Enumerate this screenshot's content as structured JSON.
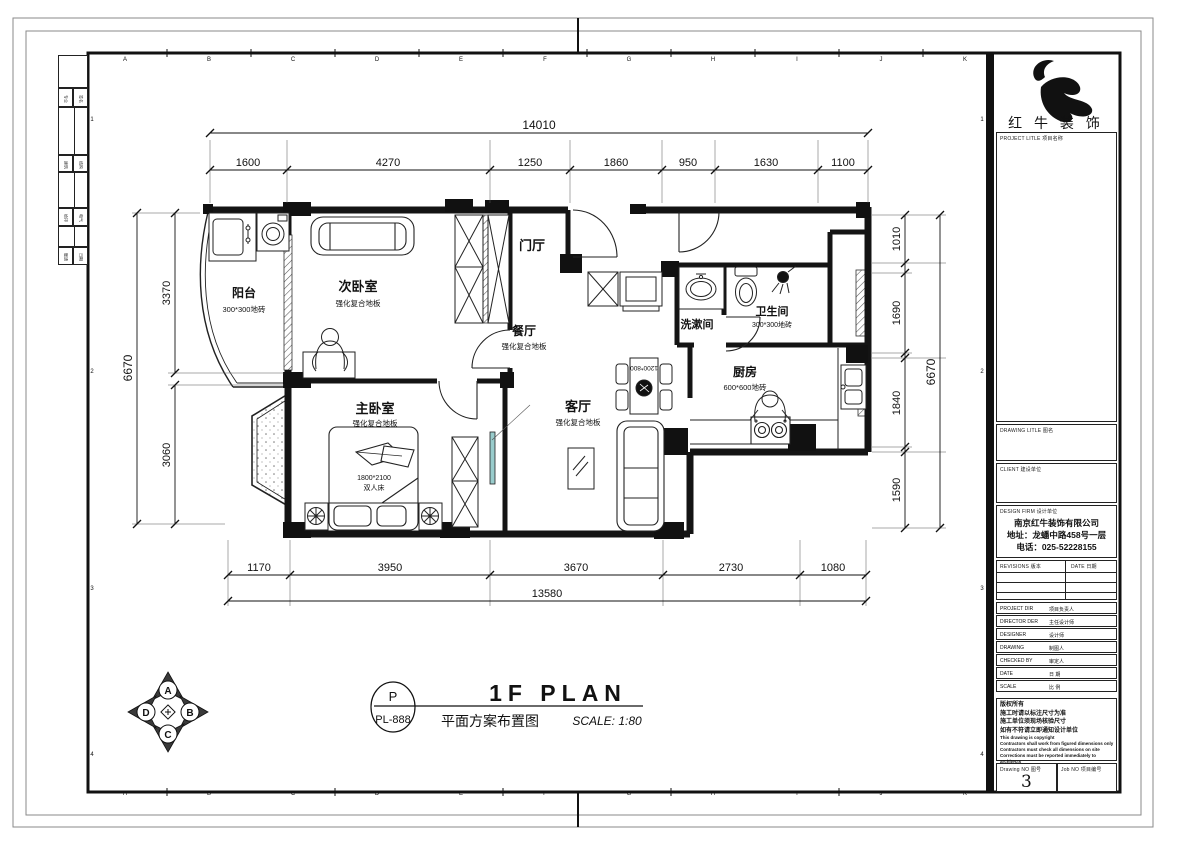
{
  "sheet": {
    "grid_top": [
      "A",
      "B",
      "C",
      "D",
      "E",
      "F",
      "G",
      "H",
      "I",
      "J",
      "K"
    ],
    "grid_side": [
      "1",
      "2",
      "3",
      "4"
    ],
    "side_strip": [
      [
        "专业",
        "签名"
      ],
      [
        "建筑",
        "结构"
      ],
      [
        "给排",
        "电气"
      ],
      [
        "暖通",
        "日期"
      ]
    ]
  },
  "title_block": {
    "logo_text": "红 牛 装 饰",
    "project_title_label": "PROJECT LITLE  项目名称",
    "drawing_title_label": "DRAWING LITLE  图名",
    "client_label": "CLIENT  建设单位",
    "design_firm_label": "DESIGN FIRM  设计单位",
    "company_name": "南京红牛装饰有限公司",
    "company_address": "地址：龙蟠中路458号一层",
    "company_phone": "电话：025-52228155",
    "revisions_label": "REVISIONS  版本",
    "date_col_label": "DATE  日期",
    "fields": [
      {
        "en": "PROJECT DIR",
        "cn": "项目负责人"
      },
      {
        "en": "DIRECTOR DER",
        "cn": "主任设计师"
      },
      {
        "en": "DESIGNER",
        "cn": "设计师"
      },
      {
        "en": "DRAWING",
        "cn": "制图人"
      },
      {
        "en": "CHECKED BY",
        "cn": "审定人"
      },
      {
        "en": "DATE",
        "cn": "日  期"
      },
      {
        "en": "SCALE",
        "cn": "比  例"
      }
    ],
    "copyright_cn": [
      "版权所有",
      "施工时请以标注尺寸为准",
      "施工单位须现场核验尺寸",
      "如有不符请立即通知设计单位"
    ],
    "copyright_en": [
      "This drawing is copyright",
      "Contractors shall work from figured dimensions only",
      "Contractors must check all dimensions on site",
      "Corrections must be reported immediately to architects"
    ],
    "drawing_no_label": "Drawing NO  图号",
    "drawing_no": "3",
    "job_no_label": "Job NO  项目编号"
  },
  "plan": {
    "rooms": {
      "balcony": {
        "name": "阳台",
        "finish": "300*300地砖"
      },
      "secondary_bedroom": {
        "name": "次卧室",
        "finish": "强化复合地板"
      },
      "entry": {
        "name": "门厅"
      },
      "dining": {
        "name": "餐厅",
        "finish": "强化复合地板"
      },
      "washroom": {
        "name": "洗漱间"
      },
      "bathroom": {
        "name": "卫生间",
        "finish": "300*300地砖"
      },
      "kitchen": {
        "name": "厨房",
        "finish": "600*600地砖"
      },
      "living": {
        "name": "客厅",
        "finish": "强化复合地板"
      },
      "master_bedroom": {
        "name": "主卧室",
        "finish": "强化复合地板"
      }
    },
    "furniture": {
      "bed_size": "1800*2100",
      "bed_type": "双人床",
      "dining_table_size": "1200*800"
    }
  },
  "dims": {
    "top": {
      "overall": "14010",
      "segs": [
        "1600",
        "4270",
        "1250",
        "1860",
        "950",
        "1630",
        "1100"
      ]
    },
    "bottom": {
      "overall": "13580",
      "segs": [
        "1170",
        "3950",
        "3670",
        "2730",
        "1080"
      ]
    },
    "left": {
      "overall": "6670",
      "segs": [
        "3370",
        "3060"
      ]
    },
    "right": {
      "overall": "6670",
      "segs": [
        "1010",
        "1690",
        "1840",
        "1590"
      ]
    }
  },
  "title_bar": {
    "code_letter": "P",
    "code": "PL-888",
    "title_en": "1F PLAN",
    "title_cn": "平面方案布置图",
    "scale_text": "SCALE: 1:80"
  },
  "compass": {
    "top": "A",
    "right": "B",
    "bottom": "C",
    "left": "D"
  }
}
